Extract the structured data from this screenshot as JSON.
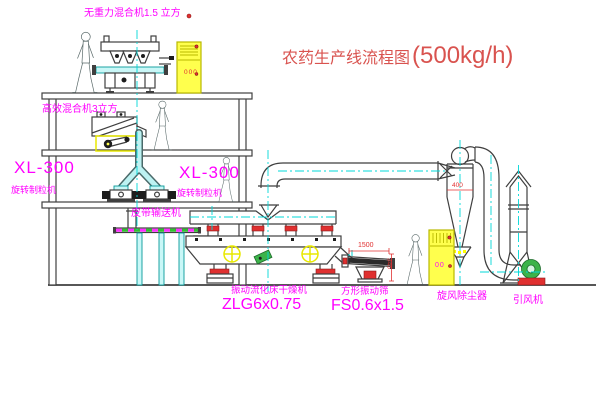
{
  "diagram": {
    "title": "农药生产线流程图",
    "capacity": "(500kg/h)"
  },
  "labels": {
    "gravity_mixer": "无重力混合机1.5 立方",
    "efficient_mixer": "高效混合机3立方",
    "granulator_left_model": "XL-300",
    "granulator_left_name": "旋转制粒机",
    "granulator_mid_model": "XL-300",
    "granulator_mid_name": "旋转制粒机",
    "belt_conveyor": "皮带输送机",
    "dryer_name": "振动流化床干燥机",
    "dryer_model": "ZLG6x0.75",
    "sieve_name": "方形振动筛",
    "sieve_model": "FS0.6x1.5",
    "cyclone": "旋风除尘器",
    "fan": "引风机"
  },
  "dimensions": {
    "sieve_length": "1500",
    "sieve_height": "345",
    "cyclone_width": "400"
  },
  "panel_marks": {
    "top_cabinet": "000",
    "side_cabinet": "00"
  },
  "colors": {
    "label_magenta": "#ff00ff",
    "title_red": "#d9534f",
    "line_dark": "#3f3f3f",
    "centerline_cyan": "#00d8d8",
    "cabinet_yellow": "#ffff4d",
    "accent_red": "#e03030",
    "accent_green": "#3cb34a"
  }
}
